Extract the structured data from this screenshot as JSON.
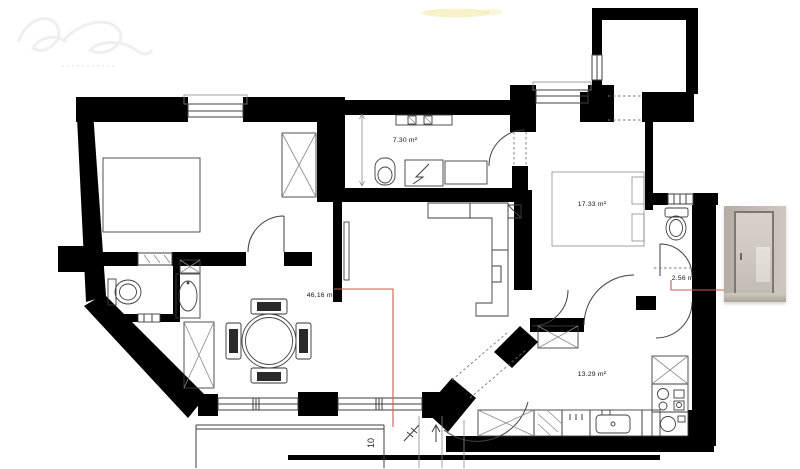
{
  "page": {
    "background": "#ffffff"
  },
  "colors": {
    "wall": "#000000",
    "line": "#3f3f3f",
    "lightline": "#8a8a8a",
    "red": "#c4604e",
    "label": "#141414",
    "watermark": "#e2e2e2",
    "highlight": "#f1eaa6"
  },
  "labels": {
    "hall_area": "7.30 m²",
    "bedroom_area": "17.33 m²",
    "living_area": "46,16 m²",
    "wc_area": "2.56 m²",
    "kitchen_area": "13.29 m²",
    "dimension": "10"
  },
  "photo": {
    "subject": "interior photo of a glass door"
  },
  "watermark": {
    "subject": "faint illegible cursive studio logo"
  }
}
